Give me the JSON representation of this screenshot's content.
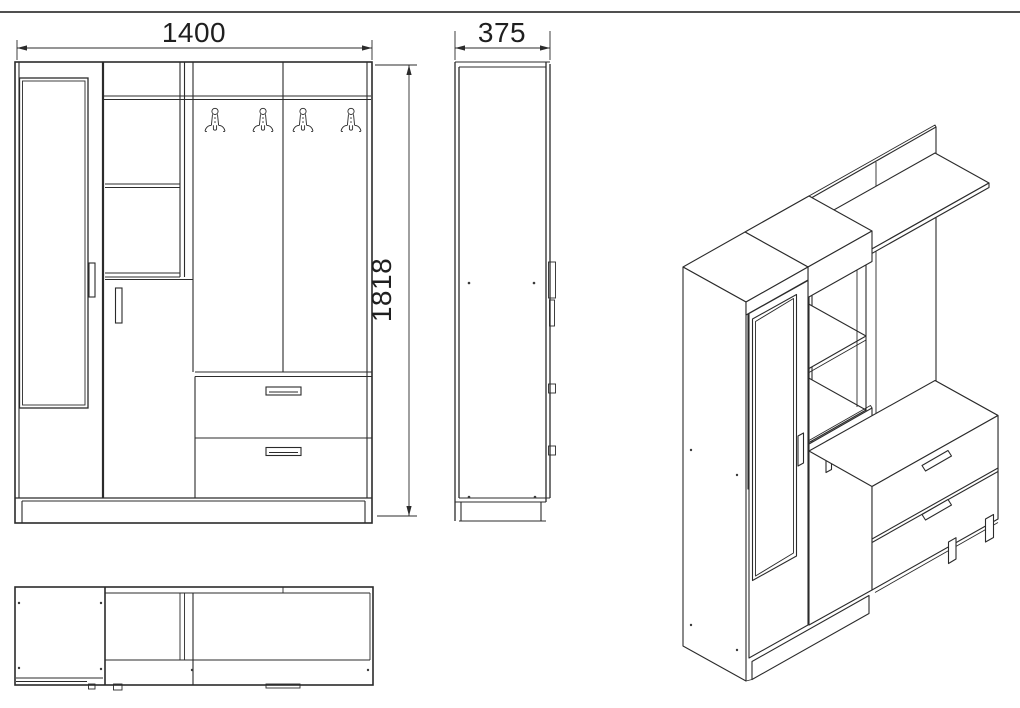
{
  "page": {
    "kind": "furniture-technical-drawing",
    "background": "#ffffff",
    "line_color": "#2b2b2b",
    "dim_text_color": "#1f1f1f",
    "top_rule_color": "#161616"
  },
  "dims": {
    "front_width": "1400",
    "front_height": "1818",
    "side_depth": "375"
  },
  "views": {
    "front": "front-elevation",
    "side": "side-elevation",
    "plan": "top-plan-view",
    "iso": "isometric-projection"
  },
  "components": {
    "coat_hooks": 4,
    "drawers": 2,
    "doors": 2,
    "mirror_doors": 1,
    "open_shelves": 2,
    "top_shelf": 1
  }
}
